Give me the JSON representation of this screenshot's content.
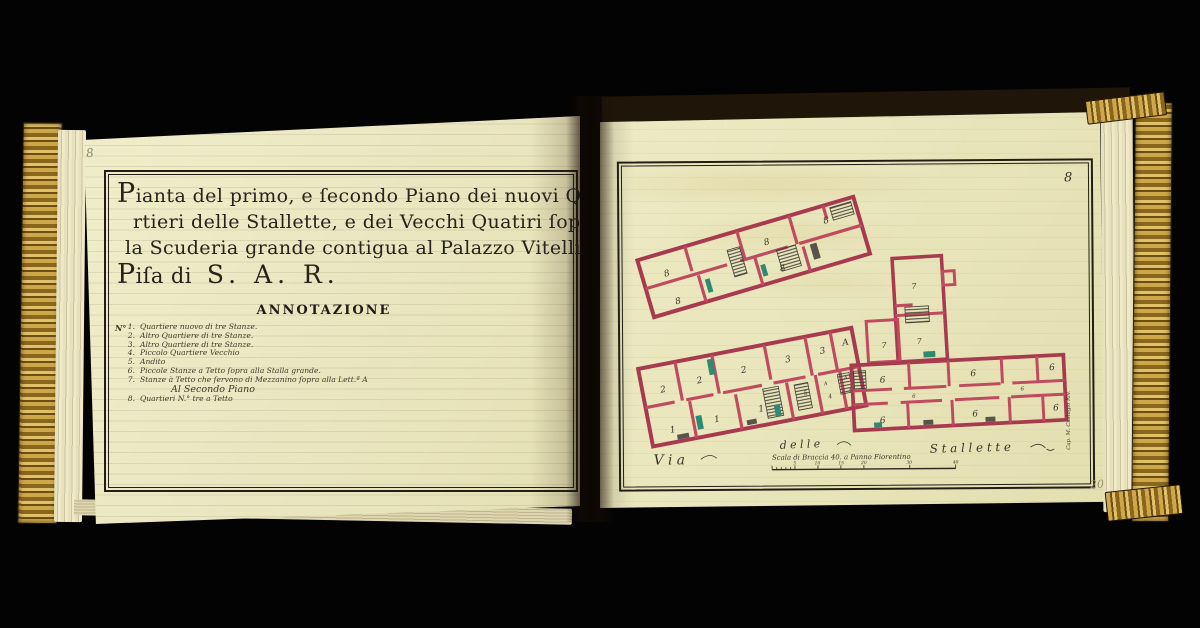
{
  "left_page": {
    "pencil_folio": "8",
    "title_lines": [
      "Pianta del primo, e ſecondo Piano dei nuovi Qua",
      "rtieri delle Stallette, e dei Vecchi Quatiri ſopra",
      "la Scuderia grande contigua al Palazzo Vitelli in"
    ],
    "title_line4": {
      "prefix": "Piſa di",
      "sar": "S. A. R."
    },
    "annotation_heading": "ANNOTAZIONE",
    "list_label": "N°",
    "items": [
      {
        "num": "1.",
        "text": "Quartiere nuovo di tre Stanze."
      },
      {
        "num": "2.",
        "text": "Altro Quartiere di tre Stanze."
      },
      {
        "num": "3.",
        "text": "Altro Quartiere di tre Stanze."
      },
      {
        "num": "4.",
        "text": "Piccolo Quartiere Vecchio"
      },
      {
        "num": "5.",
        "text": "Andito"
      },
      {
        "num": "6.",
        "text": "Piccole Stanze a Tetto ſopra alla Stalla grande."
      },
      {
        "num": "7.",
        "text": "Stanze à Tetto che ſervono di Mezzanino ſopra alla Lett.ª A"
      },
      {
        "num": "8.",
        "text": "Quartieri N.° tre a Tetto"
      }
    ],
    "item7_subline": "Al Secondo Piano"
  },
  "right_page": {
    "folio_number": "8",
    "pencil_note": "20",
    "plan_upper": {
      "room_labels": [
        "8",
        "8",
        "8",
        "8",
        "8"
      ]
    },
    "plan_annex": {
      "room_labels": [
        "7",
        "7",
        "7"
      ]
    },
    "plan_lower": {
      "top_labels": [
        "2",
        "2",
        "2",
        "3",
        "3",
        "A"
      ],
      "bottom_labels": [
        "1",
        "1",
        "1",
        "5",
        "4",
        "4"
      ],
      "tiny_labels": [
        "A",
        "A"
      ]
    },
    "plan_wing": {
      "room_labels": [
        "6",
        "6",
        "6",
        "6",
        "6",
        "6",
        "6",
        "6"
      ]
    },
    "street": {
      "via": "V i a",
      "delle": "d e l l e",
      "stallette": "S t a l l e t t e"
    },
    "scale": {
      "label": "Scala di Braccia 40. a Panno Fiorentino",
      "ticks": [
        "5",
        "10",
        "15",
        "20",
        "30",
        "40"
      ]
    },
    "signature": "Cap. M. Castagio Riv."
  },
  "colors": {
    "wall_crimson": "#c04a5e",
    "accent_green": "#2e8b72",
    "page_cream": "#ebe7c2",
    "gilt_gold": "#cda74a",
    "ink": "#28231a"
  }
}
